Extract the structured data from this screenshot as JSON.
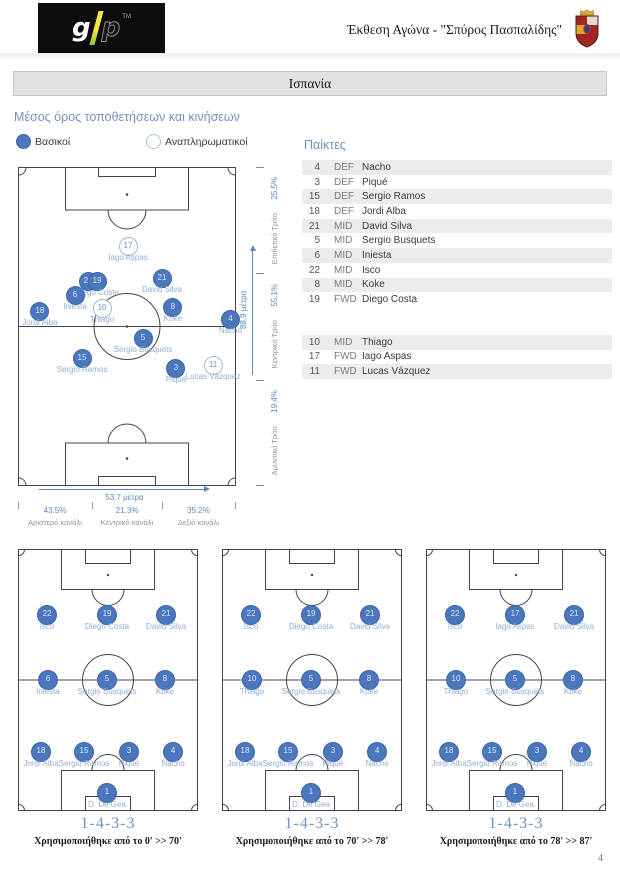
{
  "header": {
    "logo": {
      "g": "g",
      "p": "p",
      "tm": "TM"
    },
    "title": "Έκθεση Αγώνα - \"Σπύρος Πασπαλίδης\"",
    "crest": "spain-crest"
  },
  "team_bar": "Ισπανία",
  "page_number": "4",
  "colors": {
    "accent_blue": "#5b87c5",
    "starter_fill": "#4a77bd",
    "sub_stroke": "#9fb9da",
    "player_label": "#93acd3",
    "section_title": "#7492bb",
    "bar_gray": "#e2e2e2",
    "row_shade": "#ececec"
  },
  "avg_section": {
    "title": "Μέσος όρος τοποθετήσεων και κινήσεων",
    "legend": {
      "starters": "Βασικοί",
      "subs": "Αναπληρωματικοί"
    },
    "players": [
      {
        "num": "17",
        "name": "Iago Aspas",
        "x": 50,
        "y": 24.5,
        "sub": true
      },
      {
        "num": "22",
        "name": "Isco",
        "x": 31.7,
        "y": 35.7,
        "label_hidden": true
      },
      {
        "num": "19",
        "name": "Diego Costa",
        "x": 35.8,
        "y": 35.7
      },
      {
        "num": "21",
        "name": "David Silva",
        "x": 65.6,
        "y": 34.5
      },
      {
        "num": "6",
        "name": "Iniesta",
        "x": 25.7,
        "y": 40.1
      },
      {
        "num": "10",
        "name": "Thiago",
        "x": 38.1,
        "y": 44.2,
        "sub": true
      },
      {
        "num": "8",
        "name": "Koke",
        "x": 70.6,
        "y": 43.6
      },
      {
        "num": "18",
        "name": "Jordi Alba",
        "x": 9.6,
        "y": 45.1
      },
      {
        "num": "4",
        "name": "Nacho",
        "x": 97,
        "y": 47.6
      },
      {
        "num": "5",
        "name": "Sergio Busquets",
        "x": 56.9,
        "y": 53.6
      },
      {
        "num": "15",
        "name": "Sergio Ramos",
        "x": 28.9,
        "y": 59.6
      },
      {
        "num": "3",
        "name": "Piqué",
        "x": 72,
        "y": 62.7
      },
      {
        "num": "11",
        "name": "Lucas Vázquez",
        "x": 89,
        "y": 61.8,
        "sub": true
      }
    ],
    "vertical_axis": {
      "arrow_label": "88.9 μέτρα",
      "sections": [
        {
          "label": "Επιθετικό Τρίτο",
          "pct": "25.5%"
        },
        {
          "label": "Κεντρικό Τρίτο",
          "pct": "55.1%"
        },
        {
          "label": "Αμυντικό Τρίτο",
          "pct": "19.4%"
        }
      ]
    },
    "horizontal_axis": {
      "arrow_label": "53.7 μέτρα",
      "channels": [
        {
          "pct": "43.5%",
          "label": "Αριστερό κανάλι"
        },
        {
          "pct": "21.3%",
          "label": "Κεντρικό κανάλι"
        },
        {
          "pct": "35.2%",
          "label": "Δεξιό κανάλι"
        }
      ]
    }
  },
  "roster": {
    "title": "Παίκτες",
    "starters": [
      {
        "num": "4",
        "pos": "DEF",
        "name": "Nacho"
      },
      {
        "num": "3",
        "pos": "DEF",
        "name": "Piqué"
      },
      {
        "num": "15",
        "pos": "DEF",
        "name": "Sergio Ramos"
      },
      {
        "num": "18",
        "pos": "DEF",
        "name": "Jordi Alba"
      },
      {
        "num": "21",
        "pos": "MID",
        "name": "David Silva"
      },
      {
        "num": "5",
        "pos": "MID",
        "name": "Sergio Busquets"
      },
      {
        "num": "6",
        "pos": "MID",
        "name": "Iniesta"
      },
      {
        "num": "22",
        "pos": "MID",
        "name": "Isco"
      },
      {
        "num": "8",
        "pos": "MID",
        "name": "Koke"
      },
      {
        "num": "19",
        "pos": "FWD",
        "name": "Diego Costa"
      }
    ],
    "substitutes": [
      {
        "num": "10",
        "pos": "MID",
        "name": "Thiago"
      },
      {
        "num": "17",
        "pos": "FWD",
        "name": "Iago Aspas"
      },
      {
        "num": "11",
        "pos": "FWD",
        "name": "Lucas Vázquez"
      }
    ]
  },
  "formations": [
    {
      "name": "1-4-3-3",
      "caption": "Χρησιμοποιήθηκε από το 0' >> 70'",
      "players": [
        {
          "num": "22",
          "name": "Isco",
          "x": 15.6,
          "y": 24.8
        },
        {
          "num": "19",
          "name": "Diego Costa",
          "x": 48.9,
          "y": 24.8
        },
        {
          "num": "21",
          "name": "David Silva",
          "x": 81.7,
          "y": 24.8
        },
        {
          "num": "6",
          "name": "Iniesta",
          "x": 16.1,
          "y": 49.6
        },
        {
          "num": "5",
          "name": "Sergio Busquets",
          "x": 48.9,
          "y": 49.6
        },
        {
          "num": "8",
          "name": "Koke",
          "x": 81.1,
          "y": 49.6
        },
        {
          "num": "18",
          "name": "Jordi Alba",
          "x": 12.2,
          "y": 77.1
        },
        {
          "num": "15",
          "name": "Sergio Ramos",
          "x": 36.1,
          "y": 77.1
        },
        {
          "num": "3",
          "name": "Piqué",
          "x": 61.1,
          "y": 77.1
        },
        {
          "num": "4",
          "name": "Nacho",
          "x": 85.6,
          "y": 77.1
        },
        {
          "num": "1",
          "name": "D. De Gea",
          "x": 48.9,
          "y": 92.7
        }
      ]
    },
    {
      "name": "1-4-3-3",
      "caption": "Χρησιμοποιήθηκε από το 70' >> 78'",
      "players": [
        {
          "num": "22",
          "name": "Isco",
          "x": 15.6,
          "y": 24.8
        },
        {
          "num": "19",
          "name": "Diego Costa",
          "x": 48.9,
          "y": 24.8
        },
        {
          "num": "21",
          "name": "David Silva",
          "x": 81.7,
          "y": 24.8
        },
        {
          "num": "10",
          "name": "Thiago",
          "x": 16.1,
          "y": 49.6
        },
        {
          "num": "5",
          "name": "Sergio Busquets",
          "x": 48.9,
          "y": 49.6
        },
        {
          "num": "8",
          "name": "Koke",
          "x": 81.1,
          "y": 49.6
        },
        {
          "num": "18",
          "name": "Jordi Alba",
          "x": 12.2,
          "y": 77.1
        },
        {
          "num": "15",
          "name": "Sergio Ramos",
          "x": 36.1,
          "y": 77.1
        },
        {
          "num": "3",
          "name": "Piqué",
          "x": 61.1,
          "y": 77.1
        },
        {
          "num": "4",
          "name": "Nacho",
          "x": 85.6,
          "y": 77.1
        },
        {
          "num": "1",
          "name": "D. De Gea",
          "x": 48.9,
          "y": 92.7
        }
      ]
    },
    {
      "name": "1-4-3-3",
      "caption": "Χρησιμοποιήθηκε από το 78' >> 87'",
      "players": [
        {
          "num": "22",
          "name": "Isco",
          "x": 15.6,
          "y": 24.8
        },
        {
          "num": "17",
          "name": "Iago Aspas",
          "x": 48.9,
          "y": 24.8
        },
        {
          "num": "21",
          "name": "David Silva",
          "x": 81.7,
          "y": 24.8
        },
        {
          "num": "10",
          "name": "Thiago",
          "x": 16.1,
          "y": 49.6
        },
        {
          "num": "5",
          "name": "Sergio Busquets",
          "x": 48.9,
          "y": 49.6
        },
        {
          "num": "8",
          "name": "Koke",
          "x": 81.1,
          "y": 49.6
        },
        {
          "num": "18",
          "name": "Jordi Alba",
          "x": 12.2,
          "y": 77.1
        },
        {
          "num": "15",
          "name": "Sergio Ramos",
          "x": 36.1,
          "y": 77.1
        },
        {
          "num": "3",
          "name": "Piqué",
          "x": 61.1,
          "y": 77.1
        },
        {
          "num": "4",
          "name": "Nacho",
          "x": 85.6,
          "y": 77.1
        },
        {
          "num": "1",
          "name": "D. De Gea",
          "x": 48.9,
          "y": 92.7
        }
      ]
    }
  ]
}
